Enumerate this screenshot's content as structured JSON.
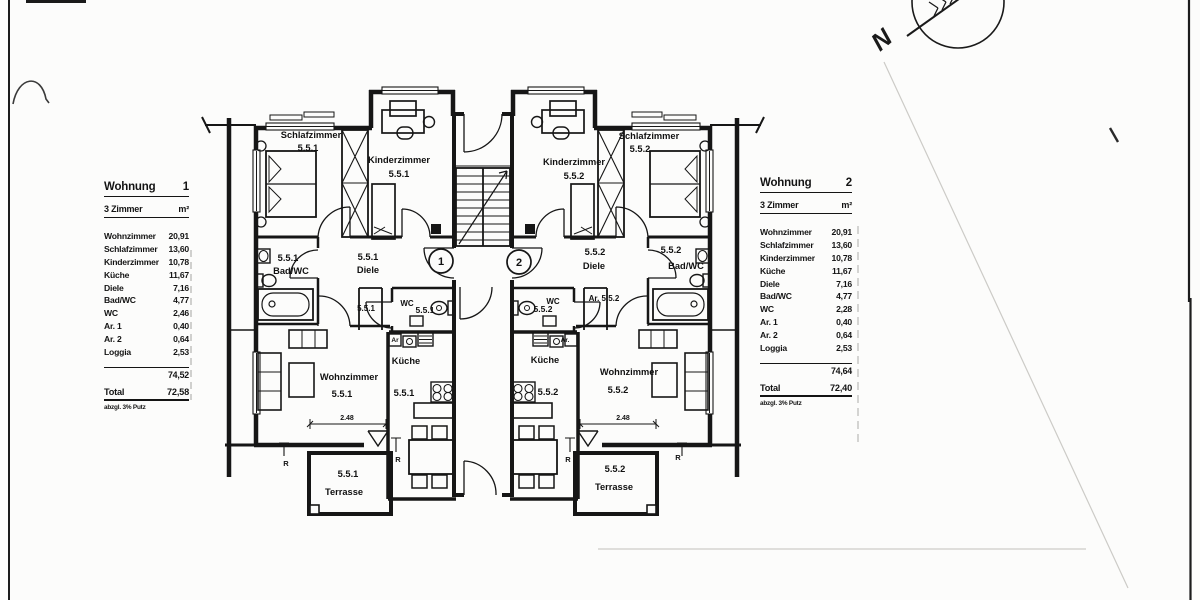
{
  "compass": {
    "north_label": "N"
  },
  "tables": [
    {
      "title": "Wohnung",
      "number": "1",
      "subtitle": "3 Zimmer",
      "unit": "m²",
      "rows": [
        {
          "label": "Wohnzimmer",
          "value": "20,91"
        },
        {
          "label": "Schlafzimmer",
          "value": "13,60"
        },
        {
          "label": "Kinderzimmer",
          "value": "10,78"
        },
        {
          "label": "Küche",
          "value": "11,67"
        },
        {
          "label": "Diele",
          "value": "7,16"
        },
        {
          "label": "Bad/WC",
          "value": "4,77"
        },
        {
          "label": "WC",
          "value": "2,46"
        },
        {
          "label": "Ar. 1",
          "value": "0,40"
        },
        {
          "label": "Ar. 2",
          "value": "0,64"
        },
        {
          "label": "Loggia",
          "value": "2,53"
        }
      ],
      "subtotal": "74,52",
      "total_label": "Total",
      "total": "72,58",
      "footnote": "abzgl. 3% Putz"
    },
    {
      "title": "Wohnung",
      "number": "2",
      "subtitle": "3 Zimmer",
      "unit": "m²",
      "rows": [
        {
          "label": "Wohnzimmer",
          "value": "20,91"
        },
        {
          "label": "Schlafzimmer",
          "value": "13,60"
        },
        {
          "label": "Kinderzimmer",
          "value": "10,78"
        },
        {
          "label": "Küche",
          "value": "11,67"
        },
        {
          "label": "Diele",
          "value": "7,16"
        },
        {
          "label": "Bad/WC",
          "value": "4,77"
        },
        {
          "label": "WC",
          "value": "2,28"
        },
        {
          "label": "Ar. 1",
          "value": "0,40"
        },
        {
          "label": "Ar. 2",
          "value": "0,64"
        },
        {
          "label": "Loggia",
          "value": "2,53"
        }
      ],
      "subtotal": "74,64",
      "total_label": "Total",
      "total": "72,40",
      "footnote": "abzgl. 3% Putz"
    }
  ],
  "plan": {
    "apt1": {
      "schlafzimmer": "Schlafzimmer",
      "schlafzimmer_num": "5.5.1",
      "kinderzimmer": "Kinderzimmer",
      "kinderzimmer_num": "5.5.1",
      "bad_num": "5.5.1",
      "bad": "Bad/WC",
      "diele_num": "5.5.1",
      "diele": "Diele",
      "abstellraum": "5.5.1",
      "wc": "WC",
      "wc_num": "5.5.1",
      "ar": "Ar",
      "kueche": "Küche",
      "kueche_num": "5.5.1",
      "wohnzimmer": "Wohnzimmer",
      "wohnzimmer_num": "5.5.1",
      "dim": "2.48",
      "rainpipe": "R",
      "terrasse_num": "5.5.1",
      "terrasse": "Terrasse"
    },
    "apt2": {
      "schlafzimmer": "Schlafzimmer",
      "schlafzimmer_num": "5.5.2",
      "kinderzimmer": "Kinderzimmer",
      "kinderzimmer_num": "5.5.2",
      "bad_num": "5.5.2",
      "bad": "Bad/WC",
      "diele_num": "5.5.2",
      "diele": "Diele",
      "abstellraum": "Ar. 5.5.2",
      "wc": "WC",
      "wc_num": "5.5.2",
      "ar": "Ar.",
      "kueche": "Küche",
      "kueche_num": "5.5.2",
      "wohnzimmer": "Wohnzimmer",
      "wohnzimmer_num": "5.5.2",
      "dim": "2.48",
      "rainpipe": "R",
      "terrasse_num": "5.5.2",
      "terrasse": "Terrasse"
    },
    "stairwell": {
      "unit1": "1",
      "unit2": "2"
    }
  }
}
